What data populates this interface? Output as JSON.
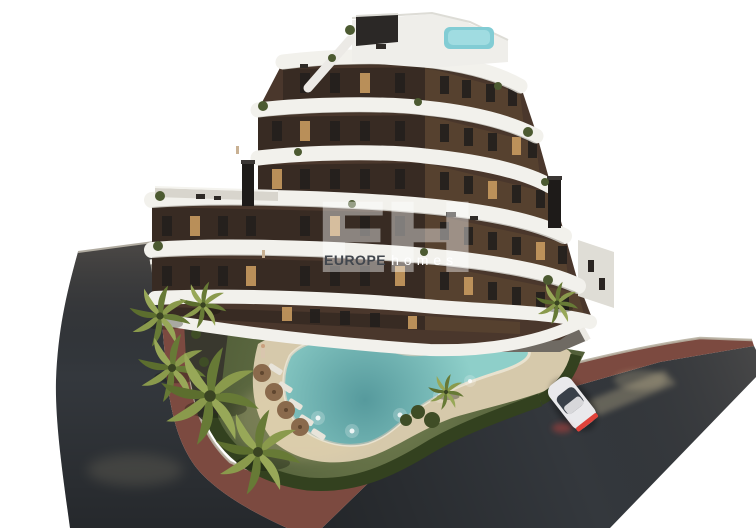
{
  "image": {
    "kind": "3d-architectural-rendering",
    "alt": "Aerial dusk render of a modern apartment building with curved white balconies, a roof terrace with plunge pool, landscaped garden with free-form swimming pool, sun loungers and parasols, palm trees, perimeter hedge, red pedestrian path and asphalt streets with one white car",
    "watermark": {
      "monogram": "EH",
      "brand_bold": "EUROPE",
      "brand_light": "homes"
    }
  },
  "colors": {
    "background": "#ffffff",
    "road": "#34383d",
    "sidewalk": "#7c4a40",
    "curb": "#b7b0a1",
    "lawn": "#5f6c42",
    "hedge": "#33411f",
    "soil": "#39382e",
    "pool_water": "#8ecfc9",
    "pool_deep": "#4e9aa2",
    "sand": "#d6c9ab",
    "facade": "#4a372c",
    "facade_shadow": "#382b23",
    "band": "#f2f1ec",
    "window": "#24201d",
    "window_lit": "#c89a5f",
    "roof_pool": "#82ccd4",
    "terrace": "#6f6a63",
    "deck_light": "#d8d5cd",
    "palm": "#8a9a4c",
    "palm_dark": "#677a36",
    "trunk": "#6f5d45",
    "umbrella": "#8a6a4c",
    "lounger": "#e8e4da",
    "car_body": "#e9e9ec",
    "car_glass": "#394049",
    "taillight": "#e0423a",
    "headlight_glow": "#e8d7a8",
    "watermark_dark": "#42474e",
    "watermark_light": "#ffffff"
  }
}
